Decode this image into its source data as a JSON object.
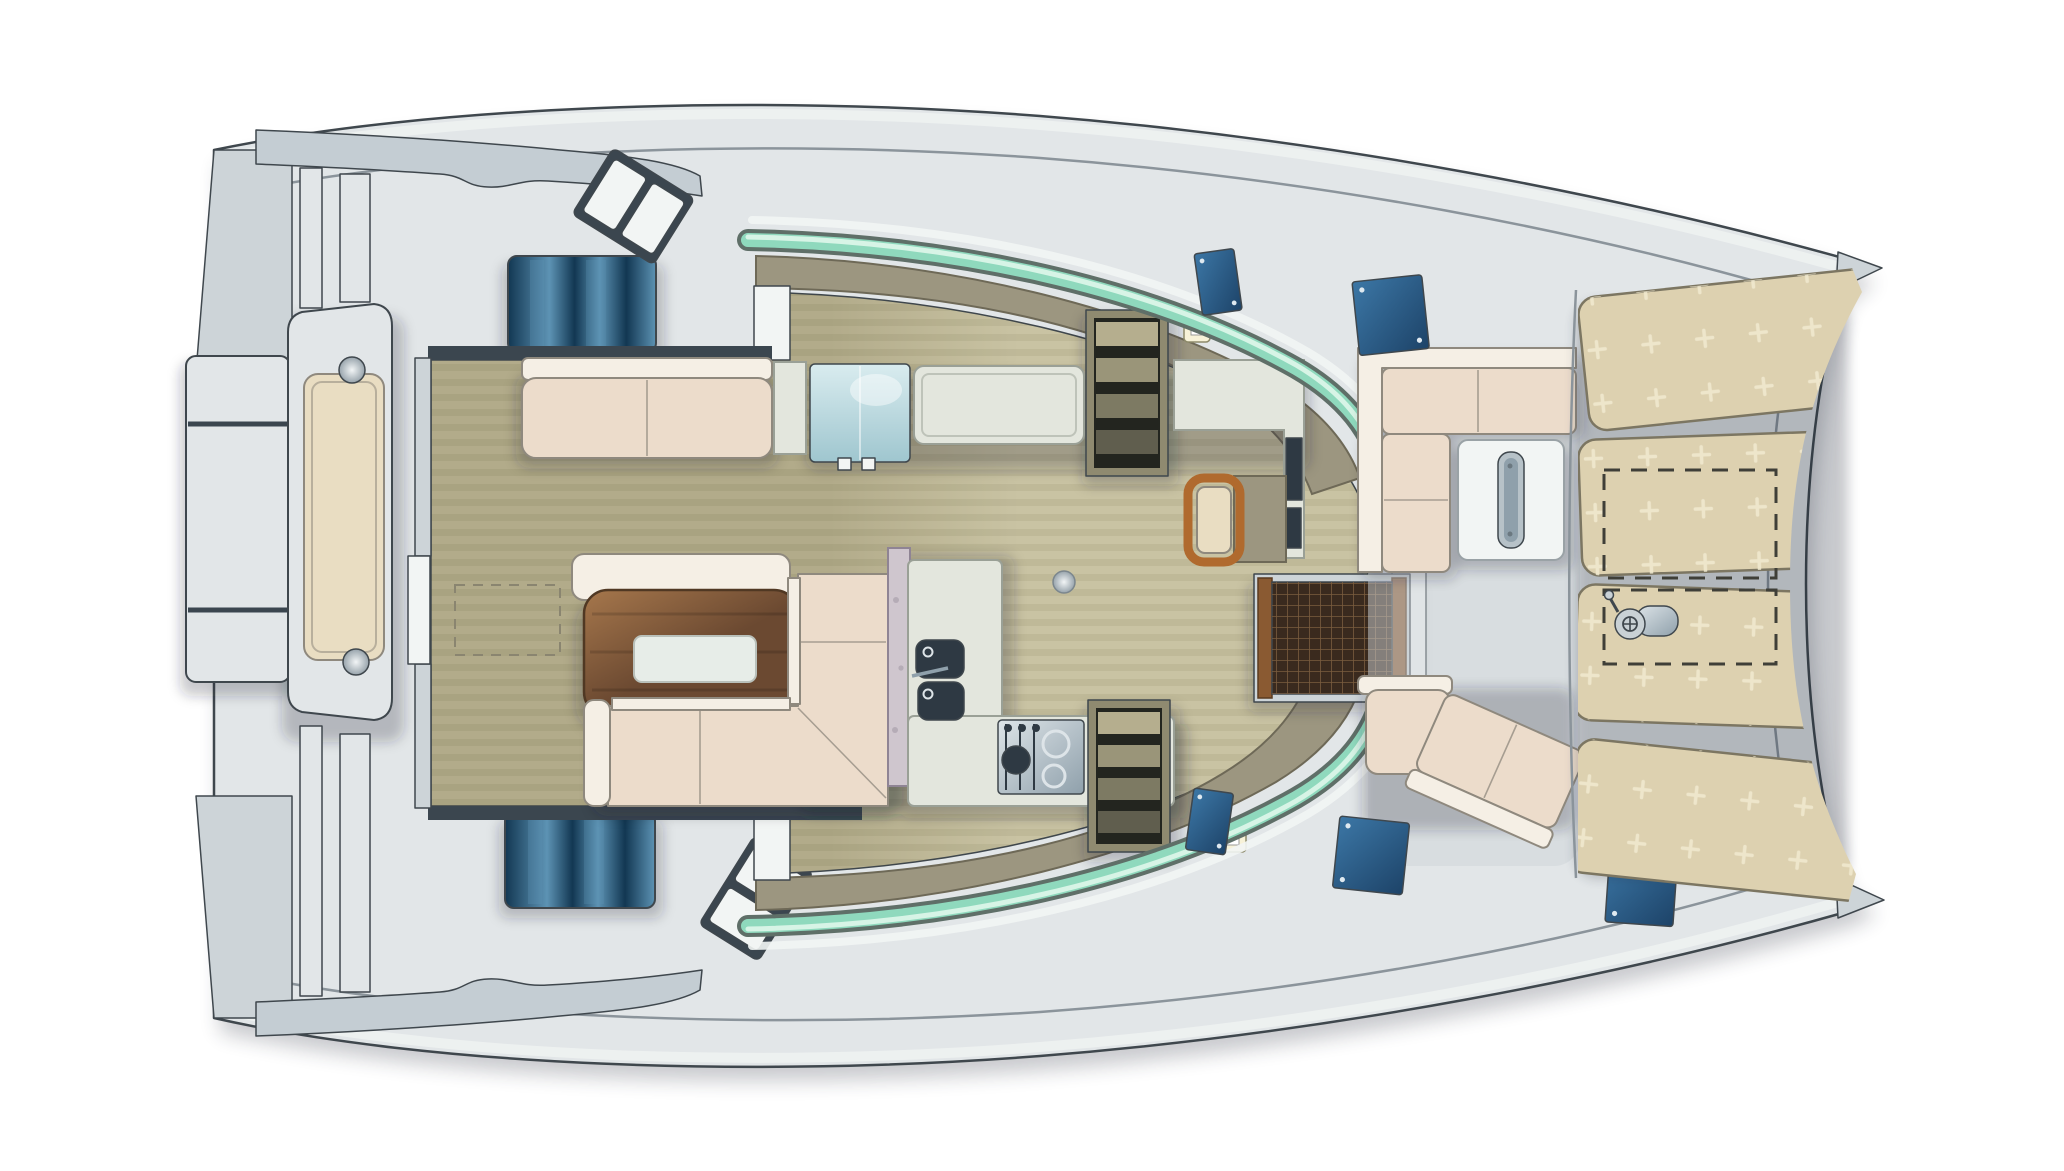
{
  "meta": {
    "title": "Catamaran yacht - main deck floor plan",
    "view": "top-down plan",
    "orientation": "bow to the right, stern to the left",
    "background": "white"
  },
  "palette": {
    "page_bg": "#ffffff",
    "outline": "#3f474d",
    "deck": "#e2e6e8",
    "deck_shade": "#cdd4d8",
    "roof_band": "#c4cdd3",
    "bulwark_line": "#8b949b",
    "white": "#f2f5f4",
    "sill_dark": "#3b464f",
    "cockpit_floor": "#b2ab8a",
    "salon_floor": "#c9c3a3",
    "sofa_seat": "#ecdccb",
    "sofa_back": "#f5efe5",
    "sofa_line": "#8f897e",
    "table_wood_light": "#a6774c",
    "table_wood_dark": "#6b4931",
    "table_edge": "#503823",
    "tray": "#e7ede8",
    "counter": "#e3e6dd",
    "counter_line": "#9aa096",
    "marble": "#cfc6ce",
    "appliance_dark": "#2e3943",
    "steel_light": "#dde4e8",
    "steel_dark": "#8fa0ab",
    "fridge_light": "#d9ecef",
    "fridge_dark": "#9fc6cf",
    "window_blue_dark": "#123752",
    "window_blue_light": "#5d93b4",
    "hatch_blue_dark": "#1d4368",
    "hatch_blue_light": "#3c77a6",
    "glass_teal": "#8fd9bd",
    "glass_teal_light": "#d7f4e6",
    "glass_edge": "#5f6f68",
    "coaming": "#9c9680",
    "coaming_line": "#6e6957",
    "sunpad": "#ddd1b0",
    "sunpad_line": "#7c7662",
    "tuft": "#f1ead0",
    "cushion_beige": "#e9ddc2",
    "stair_frame": "#8f8a70",
    "stair_dark": "#23251f",
    "stair_tread": "#b5ae8e",
    "grating_base": "#3a2a1e",
    "grating_line": "#7a5c3e",
    "grating_frame": "#8a5a32",
    "wood_chair": "#b06a2e",
    "switch_glow": "#f7f2d8",
    "fit_light": "#f2f5f6",
    "fit_dark": "#97a3ab",
    "shadow": "#1c2430"
  },
  "components": {
    "hull": "Hull and main deck",
    "swim_platform": "Aft swim platform",
    "transom_module": "Transom lounge module with cushion",
    "roof_overhang": "Coachroof overhang",
    "hull_window_port": "Port hull window",
    "hull_window_starboard": "Starboard hull window",
    "side_steps": "Side deck steps",
    "deck_vents": "Side deck vents",
    "salon": "Salon",
    "aft_sofa": "Salon aft sofa",
    "cool_box": "Glass-front cooler",
    "galley_counter": "Galley counter",
    "sink": "Galley double sink",
    "stove": "Galley stove",
    "companionway_port": "Port hull companionway stairs",
    "companionway_starboard": "Starboard hull companionway stairs",
    "nav_station": "Chart table and stool",
    "dining_table": "Salon dining table",
    "salon_sofa": "Salon L-shaped sofa",
    "windshield": "Wrap-around tinted windshield",
    "door_grating": "Forward door teak grating",
    "forward_cockpit": "Forward cockpit",
    "forward_sofa": "Forward cockpit sofa",
    "forward_table": "Forward cockpit table",
    "deck_hatches": "Deck hatches",
    "sunpads": "Foredeck sunpads",
    "anchor_locker": "Anchor locker outline",
    "windlass": "Anchor windlass",
    "light_switches": "Cabin light switches",
    "deck_fitting": "Deck fitting"
  }
}
